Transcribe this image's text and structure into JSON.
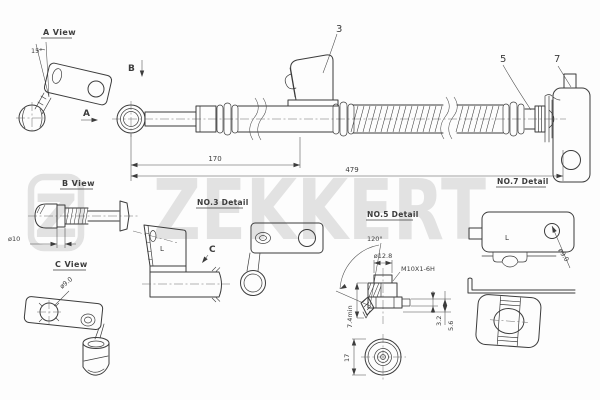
{
  "colors": {
    "line": "#3c3c3c",
    "watermark": "#e2e2e2",
    "background": "#ffffff"
  },
  "watermark": {
    "logo_letter": "Z",
    "brand": "ZEKKERT"
  },
  "views": {
    "a": {
      "label": "A View",
      "angle": "15°",
      "letter_a": "A",
      "letter_b": "B"
    },
    "b": {
      "label": "B View",
      "diameter": "ø10"
    },
    "c": {
      "label": "C View",
      "hole_diameter": "ø9.0"
    }
  },
  "main": {
    "callout_3": "3",
    "callout_5": "5",
    "callout_7": "7",
    "dim_length_1": "170",
    "dim_length_2": "479"
  },
  "details": {
    "no3": {
      "label": "NO.3 Detail",
      "marking": "L",
      "letter_c": "C"
    },
    "no5": {
      "label": "NO.5 Detail",
      "cone_angle": "120°",
      "diameter": "ø12.8",
      "thread": "M10X1-6H",
      "dim_min": "7.4min",
      "dim_1": "3.2",
      "dim_2": "5.6",
      "dim_3": "17"
    },
    "no7": {
      "label": "NO.7 Detail",
      "marking": "L",
      "hole_diameter": "ø9.0"
    }
  }
}
